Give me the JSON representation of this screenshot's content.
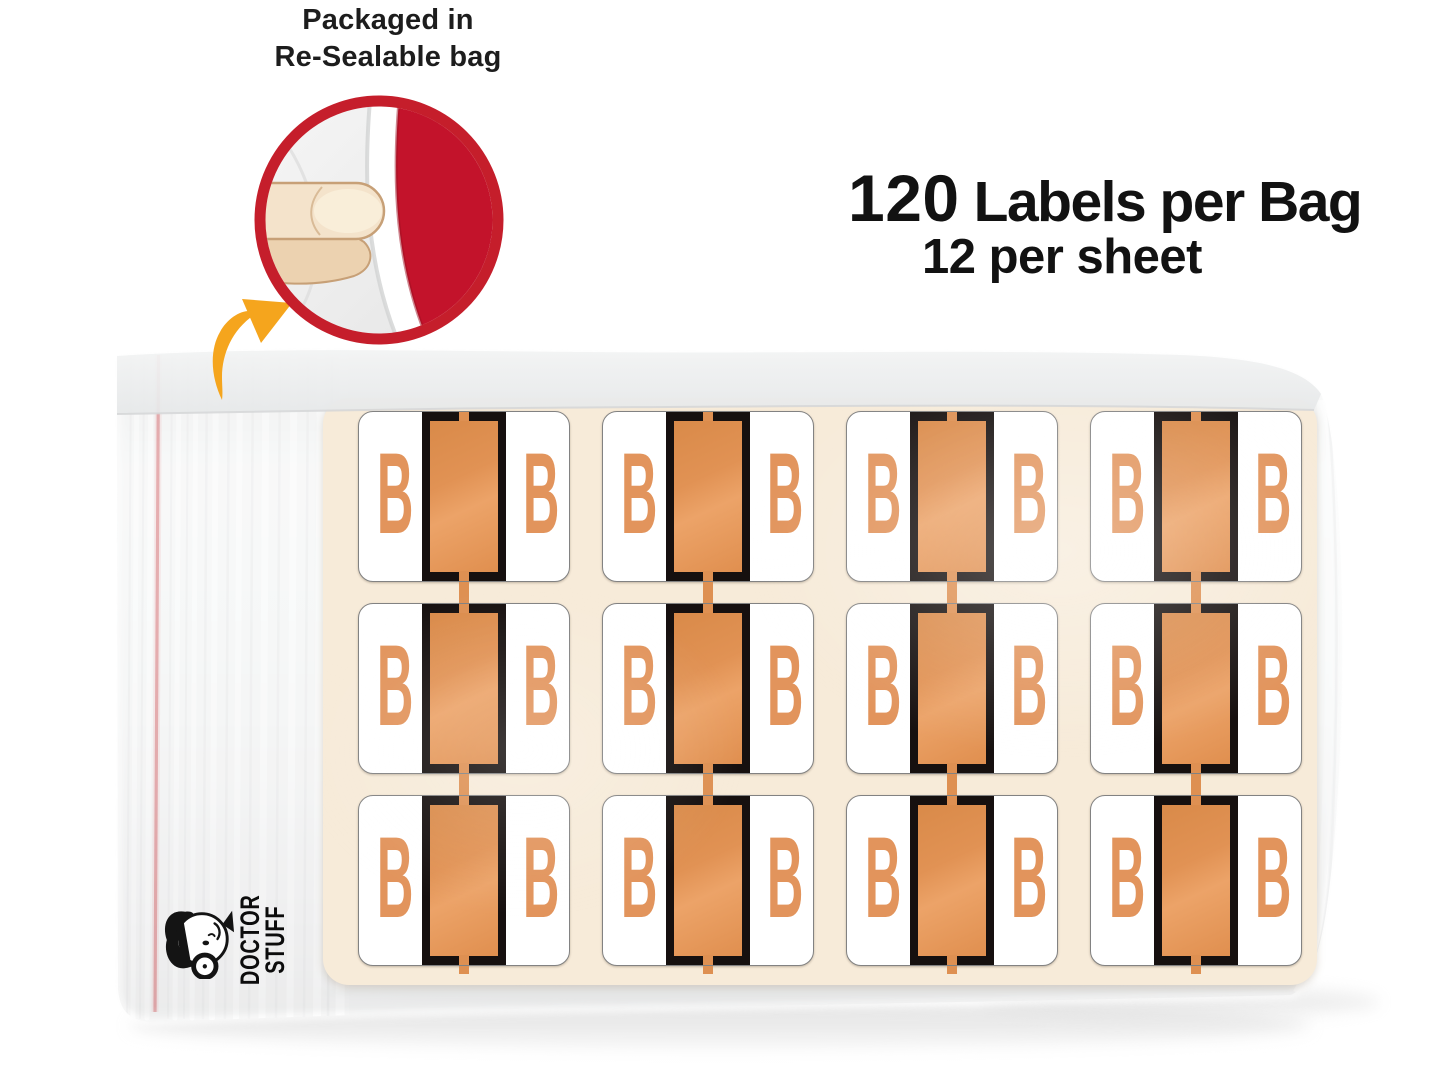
{
  "note": {
    "line1": "Packaged in",
    "line2": "Re-Sealable bag"
  },
  "count": {
    "number": "120",
    "label": "Labels per Bag",
    "per_sheet": "12 per sheet"
  },
  "logo": {
    "line1": "DOCTOR",
    "line2": "STUFF"
  },
  "sheet": {
    "letter": "B",
    "labels_visible": 12,
    "grid_rows": 3,
    "grid_columns": 4
  },
  "icons": {
    "inset": "peel-finger-resealable-bag",
    "arrow": "curved-arrow",
    "logo": "doctor-stuff-cartoon-face"
  },
  "colors": {
    "label_stripe_orange": "#e08f4f",
    "letter_orange": "#e2945c",
    "stripe_black": "#16100f",
    "sheet_cream": "#f7ebd9",
    "inset_ring_red": "#c51e2b",
    "inset_fill_red": "#c3132b",
    "bag_zip_red_line": "#c22026",
    "arrow_amber": "#f5a51d",
    "text_dark": "#121212"
  }
}
